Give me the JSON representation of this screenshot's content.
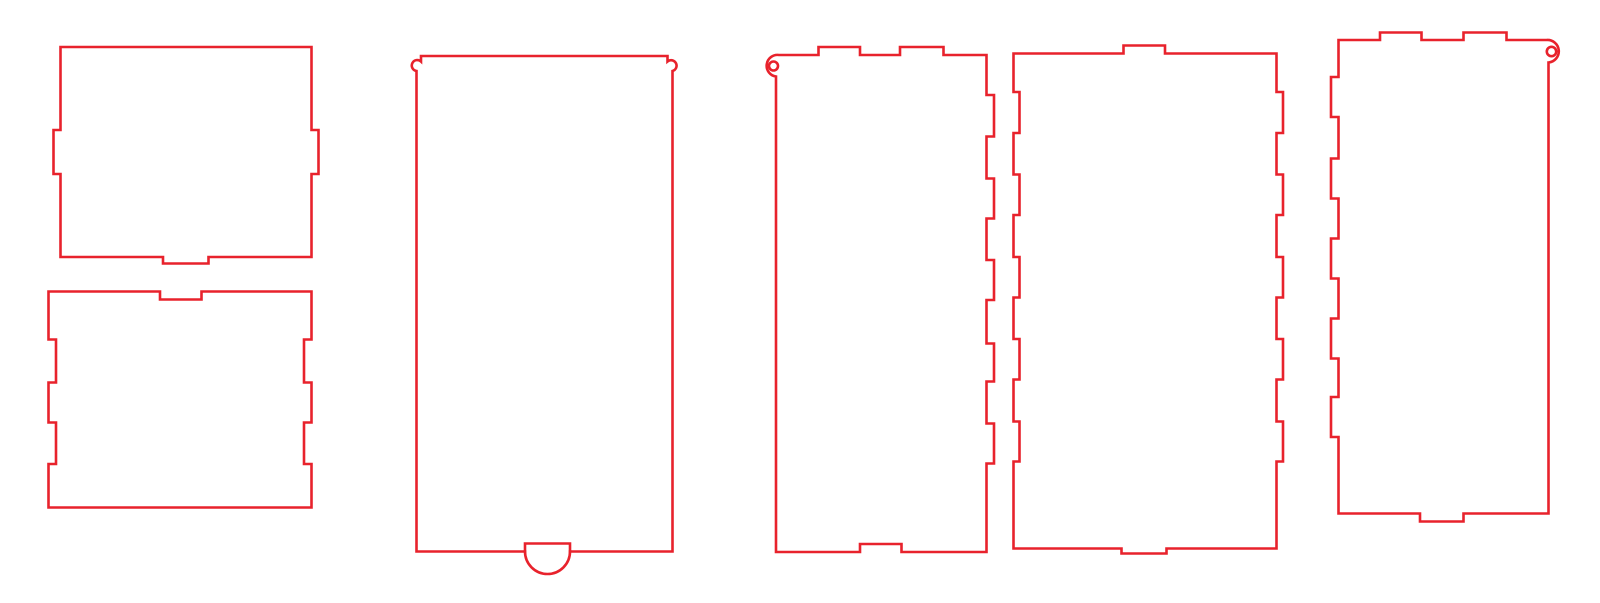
{
  "drawing": {
    "width": 1600,
    "height": 603,
    "background": "#ffffff",
    "stroke_color": "#e8222c",
    "stroke_width": 2.6,
    "panels": [
      {
        "name": "panel-top-small",
        "paths": [
          {
            "name": "panel-outline",
            "d": "M 60.5,47 H 311.5 V 130 H 318.5 V 174 H 311.5 V 257 H 208.5 V 263.5 H 163 V 257 H 60.5 V 174 H 53.5 V 130 H 60.5 Z"
          }
        ],
        "circles": []
      },
      {
        "name": "panel-bottom-small",
        "paths": [
          {
            "name": "panel-outline",
            "d": "M 48.5,291.5 H 160 V 299.5 H 201.5 V 291.5 H 311.5 V 339.5 H 304 V 382.5 H 311.5 V 422.5 H 304 V 464 H 311.5 V 507.5 H 48.5 V 464 H 56 V 422.5 H 48.5 V 382.5 H 56 V 339.5 H 48.5 Z"
          }
        ],
        "circles": []
      },
      {
        "name": "panel-sliding-lid",
        "paths": [
          {
            "name": "panel-outline",
            "d": "M 421,56 H 667.5 V 61.5 A 5.5,5.5 0 1 1 672.5,71 V 551.5 H 570 V 543.5 H 525 V 551.5 H 416.5 V 71 A 5.5,5.5 0 1 1 421,61.5 Z"
          },
          {
            "name": "finger-pull-arc",
            "d": "M 525,551.5 A 22.5,22.5 0 0 0 570,551.5"
          }
        ],
        "circles": []
      },
      {
        "name": "panel-side-a",
        "paths": [
          {
            "name": "panel-outline",
            "d": "M 779,55 H 818.5 V 47 H 860 V 55 H 900 V 47 H 943.5 V 55 H 986.5 V 95 H 994 V 136.5 H 986.5 V 178.5 H 994 V 218.5 H 986.5 V 260 H 994 V 300 H 986.5 V 343.5 H 994 V 381.5 H 986.5 V 423.5 H 994 V 463.5 H 986.5 V 552 H 901.5 V 544 H 860 V 552 H 776 V 76.5 A 10.5,10.5 0 1 1 779,55 Z"
          }
        ],
        "circles": [
          {
            "name": "hanging-hole",
            "cx": 773.5,
            "cy": 66,
            "r": 4.5
          }
        ]
      },
      {
        "name": "panel-back",
        "paths": [
          {
            "name": "panel-outline",
            "d": "M 1013.5,53.5 H 1123.5 V 45.5 H 1165 V 53.5 H 1276.5 V 92 H 1283 V 133 H 1276.5 V 174.5 H 1283 V 215 H 1276.5 V 257 H 1283 V 297.5 H 1276.5 V 339 H 1283 V 379.5 H 1276.5 V 421.5 H 1283 V 461.5 H 1276.5 V 548.5 H 1166.5 V 553.5 H 1121.5 V 548.5 H 1013.5 V 461.5 H 1019.5 V 421.5 H 1013.5 V 379.5 H 1019.5 V 339 H 1013.5 V 297.5 H 1019.5 V 257 H 1013.5 V 215 H 1019.5 V 174.5 H 1013.5 V 133 H 1019.5 V 92 H 1013.5 Z"
          }
        ],
        "circles": []
      },
      {
        "name": "panel-side-b",
        "paths": [
          {
            "name": "panel-outline",
            "d": "M 1338.5,40 H 1380 V 32.5 H 1421.5 V 40 H 1463.5 V 32.5 H 1506.5 V 40 H 1546.5 A 11,11 0 1 1 1548.5,62.5 V 513.5 H 1463.5 V 521.5 H 1420 V 513.5 H 1338.5 V 437 H 1331 V 397 H 1338.5 V 358.5 H 1331 V 318.5 H 1338.5 V 278.5 H 1331 V 238.5 H 1338.5 V 198.5 H 1331 V 158.5 H 1338.5 V 117 H 1331 V 77 H 1338.5 Z"
          }
        ],
        "circles": [
          {
            "name": "hanging-hole",
            "cx": 1551.5,
            "cy": 51.5,
            "r": 4.7
          }
        ]
      }
    ]
  }
}
